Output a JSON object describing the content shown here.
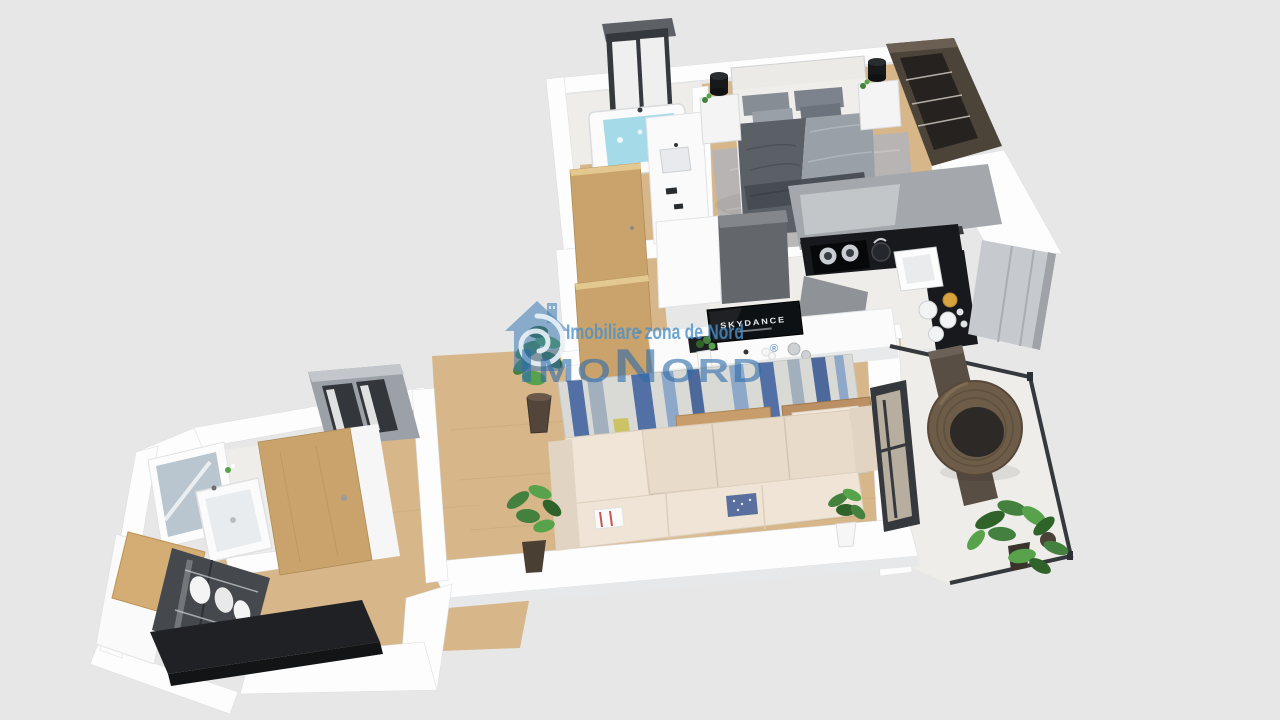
{
  "scene": {
    "type": "3d-floorplan-render",
    "subject": "Isometric 3D rendered floor plan of a one-bedroom apartment",
    "rooms": [
      "hallway",
      "bathroom",
      "bedroom",
      "kitchen",
      "living-room",
      "balcony"
    ]
  },
  "watermark": {
    "tagline": "Imobiliare zona de Nord",
    "brand": "ImoNord",
    "registered_mark": "®",
    "logo": "house-with-seahorse-spiral-icon"
  },
  "tv": {
    "brand_text": "SKYDANCE"
  },
  "palette": {
    "bg": "#e7e7e7",
    "wall": "#fdfdfd",
    "wall-shade": "#e6e8ea",
    "wood-floor": "#d7b689",
    "wood-door": "#c9a36b",
    "marble": "#efede9",
    "counter-black": "#17191c",
    "cabinet-gray": "#a4a8ac",
    "cabinet-gray-dark": "#63676c",
    "fridge-gray": "#c6c9cd",
    "dark-wood": "#4c4339",
    "water": "#a5dbe9",
    "rug-gray": "#b5b4b5",
    "rug-base": "#d9dad6",
    "rug-blue": "#35589a",
    "rug-blue-dark": "#2e4f8e",
    "rug-blue-light": "#7e9cc6",
    "rug-yellow": "#c9bd4a",
    "rug-gray-blue": "#96a5b6",
    "sofa": "#e8dbca",
    "sofa-light": "#f0e5d7",
    "table-wood": "#c79e6b",
    "green": "#44813e",
    "green-dark": "#2f6329",
    "green-light": "#58a24c",
    "frame-dark": "#35393d",
    "tv-black": "#0e1114",
    "bench-black": "#1f2124",
    "blanket-dark": "#5b5f66",
    "blanket-light": "#9aa0a7",
    "bed-white": "#f0eeeb",
    "wm-tagline": "#4a90c9",
    "wm-brand": "#2e6cab",
    "wm-logo": "#3d7ab5"
  }
}
